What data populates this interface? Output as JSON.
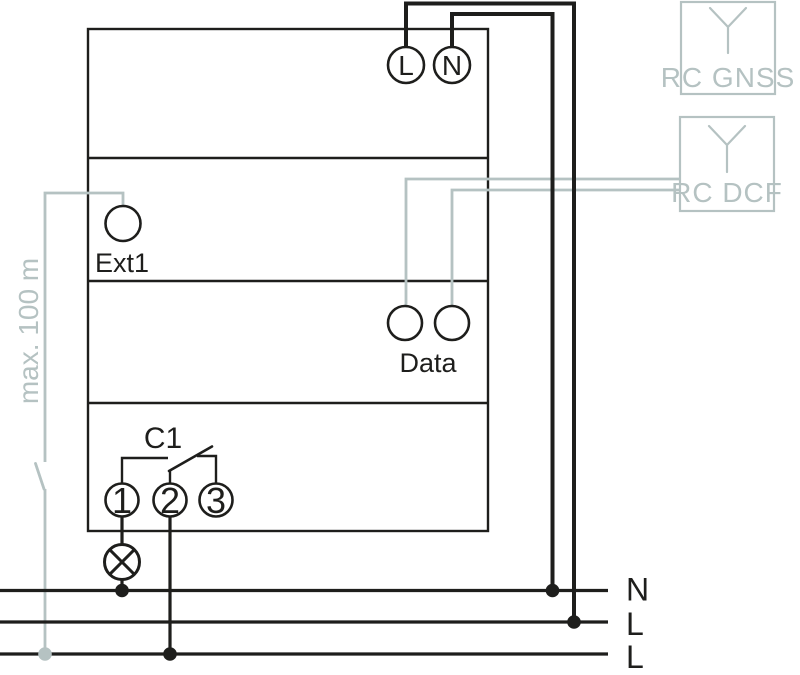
{
  "colors": {
    "line": "#1e1e1c",
    "accessory": "#b5c2c2",
    "background": "#ffffff"
  },
  "device": {
    "supply_terminals": {
      "l": "L",
      "n": "N"
    },
    "ext_terminal": {
      "label": "Ext1"
    },
    "data_terminals": {
      "label": "Data"
    },
    "relay": {
      "channel": "C1",
      "terminal_1": "1",
      "terminal_2": "2",
      "terminal_3": "3"
    }
  },
  "antennas": {
    "gnss": {
      "label": "RC GNSS"
    },
    "dcf": {
      "label": "RC DCF"
    }
  },
  "mains": {
    "labels": [
      "N",
      "L",
      "L"
    ]
  },
  "annotations": {
    "ext_cable_length": "max. 100 m"
  }
}
